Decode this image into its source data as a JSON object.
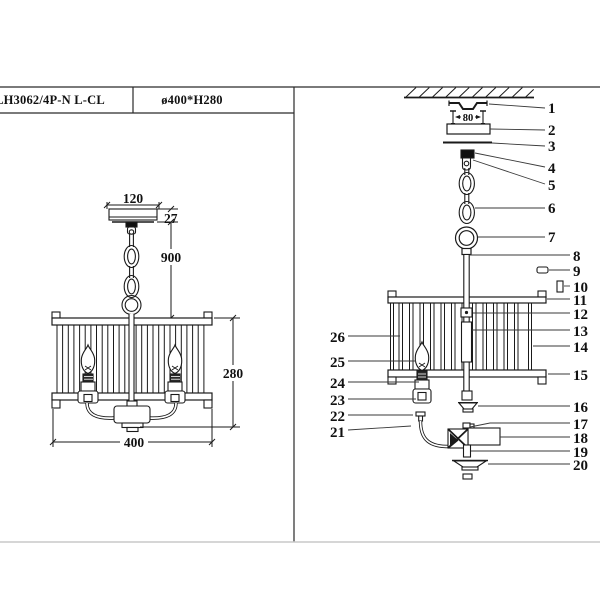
{
  "table": {
    "model": "LH3062/4P-N L-CL",
    "spec": "ø400*H280"
  },
  "dims": {
    "canopy_width": "120",
    "canopy_height": "27",
    "drop_length": "900",
    "shade_height": "280",
    "shade_diameter": "400",
    "bracket_pitch": "80"
  },
  "parts": {
    "right": [
      "1",
      "2",
      "3",
      "4",
      "5",
      "6",
      "7",
      "8",
      "9",
      "10",
      "11",
      "12",
      "13",
      "14",
      "15",
      "16",
      "17",
      "18",
      "19",
      "20"
    ],
    "left": [
      "26",
      "25",
      "24",
      "23",
      "22",
      "21"
    ]
  }
}
